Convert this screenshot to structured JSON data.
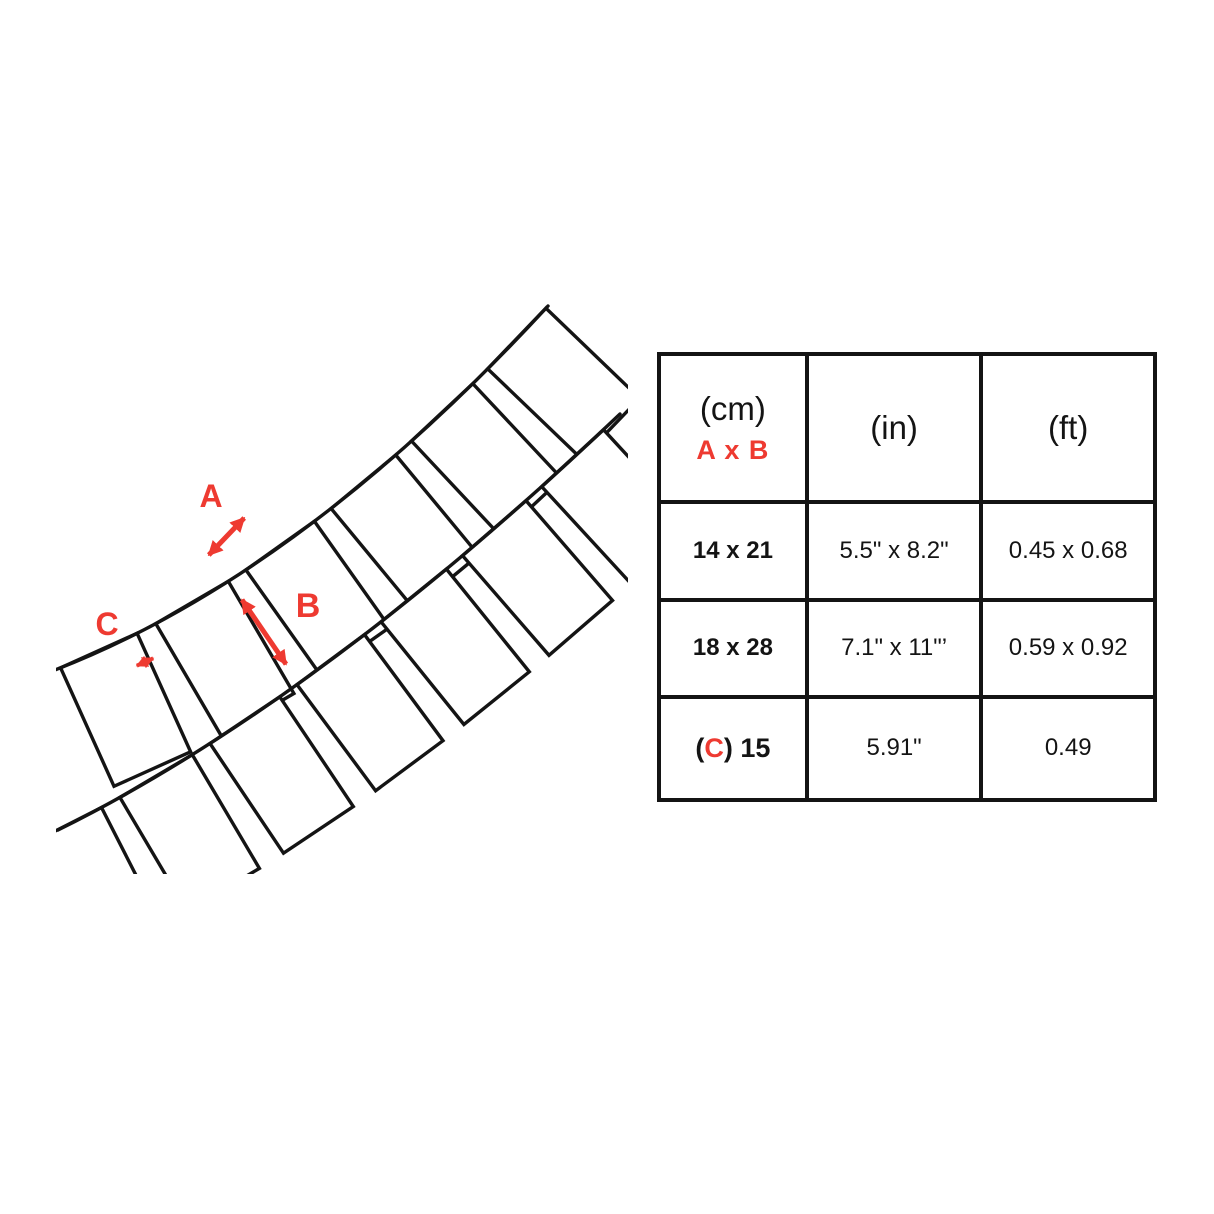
{
  "colors": {
    "accent_red": "#ee3a31",
    "ink": "#141414"
  },
  "diagram": {
    "description": "pennant banner strings with hanging rectangular flags",
    "labels": {
      "a": "A",
      "b": "B",
      "c": "C"
    }
  },
  "table": {
    "header": {
      "col1_unit": "(cm)",
      "col1_sub": "A x B",
      "col2_unit": "(in)",
      "col3_unit": "(ft)"
    },
    "rows": [
      {
        "cm": "14 x 21",
        "in": "5.5\" x 8.2\"",
        "ft": "0.45 x 0.68"
      },
      {
        "cm": "18 x 28",
        "in": "7.1\" x 11\"’",
        "ft": "0.59 x 0.92"
      },
      {
        "cm_open": "(",
        "cm_c": "C",
        "cm_close": ") 15",
        "in": "5.91\"",
        "ft": "0.49"
      }
    ]
  }
}
